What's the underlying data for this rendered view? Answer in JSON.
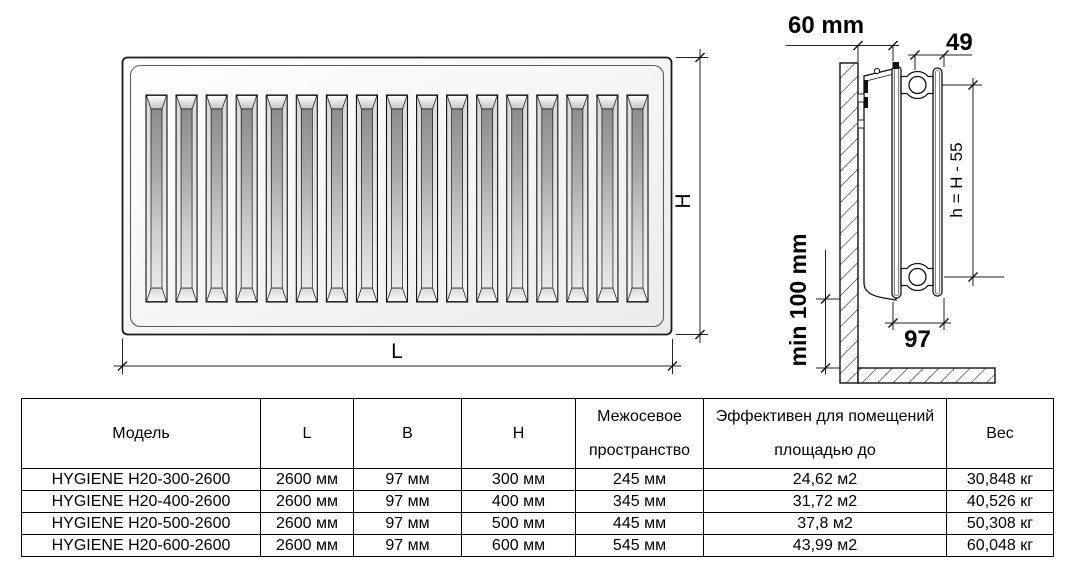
{
  "diagram": {
    "front_view": {
      "slot_count": 17,
      "label_height": "H",
      "label_length": "L"
    },
    "side_view": {
      "label_wall_distance": "60 mm",
      "label_connection_offset": "49",
      "label_axis_height": "h = H - 55",
      "label_floor_clearance": "min 100 mm",
      "label_depth": "97"
    }
  },
  "table": {
    "headers": [
      "Модель",
      "L",
      "B",
      "H",
      "Межосевое\nпространство",
      "Эффективен для помещений\nплощадью до",
      "Вес"
    ],
    "rows": [
      [
        "HYGIENE H20-300-2600",
        "2600 мм",
        "97 мм",
        "300 мм",
        "245 мм",
        "24,62 м2",
        "30,848 кг"
      ],
      [
        "HYGIENE H20-400-2600",
        "2600 мм",
        "97 мм",
        "400 мм",
        "345 мм",
        "31,72 м2",
        "40,526 кг"
      ],
      [
        "HYGIENE H20-500-2600",
        "2600 мм",
        "97 мм",
        "500 мм",
        "445 мм",
        "37,8 м2",
        "50,308 кг"
      ],
      [
        "HYGIENE H20-600-2600",
        "2600 мм",
        "97 мм",
        "600 мм",
        "545 мм",
        "43,99 м2",
        "60,048 кг"
      ]
    ]
  },
  "colors": {
    "line": "#1a1a1a",
    "text": "#000000",
    "background": "#ffffff"
  }
}
